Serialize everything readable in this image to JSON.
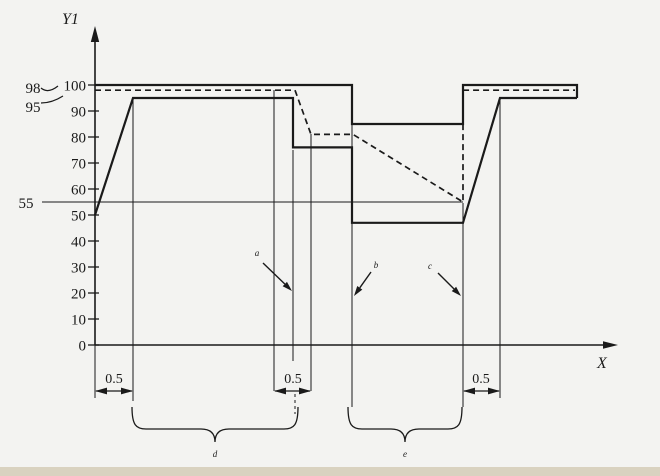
{
  "canvas": {
    "width": 660,
    "height": 476,
    "background": "#f3f3f1",
    "bottom_strip_color": "#d9d2c0",
    "line_color": "#1a1a1a"
  },
  "axes": {
    "y_axis_label": "Y1",
    "x_axis_label": "X",
    "origin": {
      "x": 95,
      "y": 345
    },
    "y_px_per_unit": 2.6,
    "y_axis_top_px": 27,
    "x_axis_end_px": 618,
    "y_ticks": [
      100,
      90,
      80,
      70,
      60,
      50,
      40,
      30,
      20,
      10,
      0
    ]
  },
  "side_labels": [
    {
      "text": "98",
      "x": 33,
      "y": 93,
      "leader": "M41,88 Q48,94 58,86"
    },
    {
      "text": "95",
      "x": 33,
      "y": 112,
      "leader": "M41,103 Q52,103 63,96"
    },
    {
      "text": "55",
      "x": 26,
      "y": 208,
      "leader": ""
    }
  ],
  "chart_data": {
    "type": "line",
    "title": "",
    "xlabel": "X",
    "ylabel": "Y1",
    "ylim": [
      0,
      110
    ],
    "y_ticks": [
      0,
      10,
      20,
      30,
      40,
      50,
      60,
      70,
      80,
      90,
      100
    ],
    "marked_levels": [
      98,
      95,
      55
    ],
    "series": [
      {
        "name": "level-55-line",
        "dash": false,
        "width": 1.1,
        "points": [
          [
            42,
            55
          ],
          [
            463,
            55
          ]
        ]
      },
      {
        "name": "dashed-curve",
        "dash": true,
        "width": 1.7,
        "points": [
          [
            95,
            98
          ],
          [
            295,
            98
          ],
          [
            311,
            81
          ],
          [
            353,
            81
          ],
          [
            463,
            55
          ],
          [
            463,
            98
          ],
          [
            575,
            98
          ]
        ]
      },
      {
        "name": "upper-envelope-line",
        "dash": false,
        "width": 2.2,
        "points": [
          [
            95,
            100
          ],
          [
            352,
            100
          ],
          [
            352,
            85
          ],
          [
            463,
            85
          ],
          [
            463,
            100
          ],
          [
            577,
            100
          ],
          [
            577,
            95
          ]
        ]
      },
      {
        "name": "main-curve-line",
        "dash": false,
        "width": 2.2,
        "points": [
          [
            95,
            50
          ],
          [
            133,
            95
          ],
          [
            293,
            95
          ],
          [
            293,
            76
          ],
          [
            352,
            76
          ],
          [
            352,
            47
          ],
          [
            463,
            47
          ],
          [
            500,
            95
          ],
          [
            577,
            95
          ]
        ]
      }
    ],
    "dimensions": [
      {
        "label": "0.5",
        "x1": 95,
        "x2": 133,
        "label_x": 114
      },
      {
        "label": "0.5",
        "x1": 274,
        "x2": 311,
        "label_x": 293
      },
      {
        "label": "0.5",
        "x1": 463,
        "x2": 500,
        "label_x": 481
      }
    ],
    "dim_style": {
      "arrow_y": 391,
      "label_y": 383
    },
    "braces": [
      {
        "label": "d",
        "x1": 132,
        "x2": 298
      },
      {
        "label": "e",
        "x1": 348,
        "x2": 462
      }
    ],
    "callouts": [
      {
        "label": "a",
        "label_x": 257,
        "label_y": 256,
        "tail": [
          263,
          263
        ],
        "tip": [
          292,
          291
        ]
      },
      {
        "label": "b",
        "label_x": 376,
        "label_y": 268,
        "tail": [
          371,
          272
        ],
        "tip": [
          354,
          296
        ]
      },
      {
        "label": "c",
        "label_x": 430,
        "label_y": 269,
        "tail": [
          438,
          273
        ],
        "tip": [
          461,
          296
        ]
      }
    ],
    "ref_lines": [
      {
        "x": 95,
        "y1": 345,
        "y2": 398,
        "dashed": false
      },
      {
        "x": 133,
        "y1": 100,
        "y2": 401,
        "dashed": false
      },
      {
        "x": 274,
        "y1": 90,
        "y2": 391,
        "dashed": false
      },
      {
        "x": 293,
        "y1": 150,
        "y2": 361,
        "dashed": false
      },
      {
        "x": 295,
        "y1": 394,
        "y2": 414,
        "dashed": true
      },
      {
        "x": 311,
        "y1": 134,
        "y2": 391,
        "dashed": false
      },
      {
        "x": 352,
        "y1": 85,
        "y2": 407,
        "dashed": false
      },
      {
        "x": 463,
        "y1": 203,
        "y2": 407,
        "dashed": false
      },
      {
        "x": 500,
        "y1": 100,
        "y2": 398,
        "dashed": false
      }
    ]
  }
}
